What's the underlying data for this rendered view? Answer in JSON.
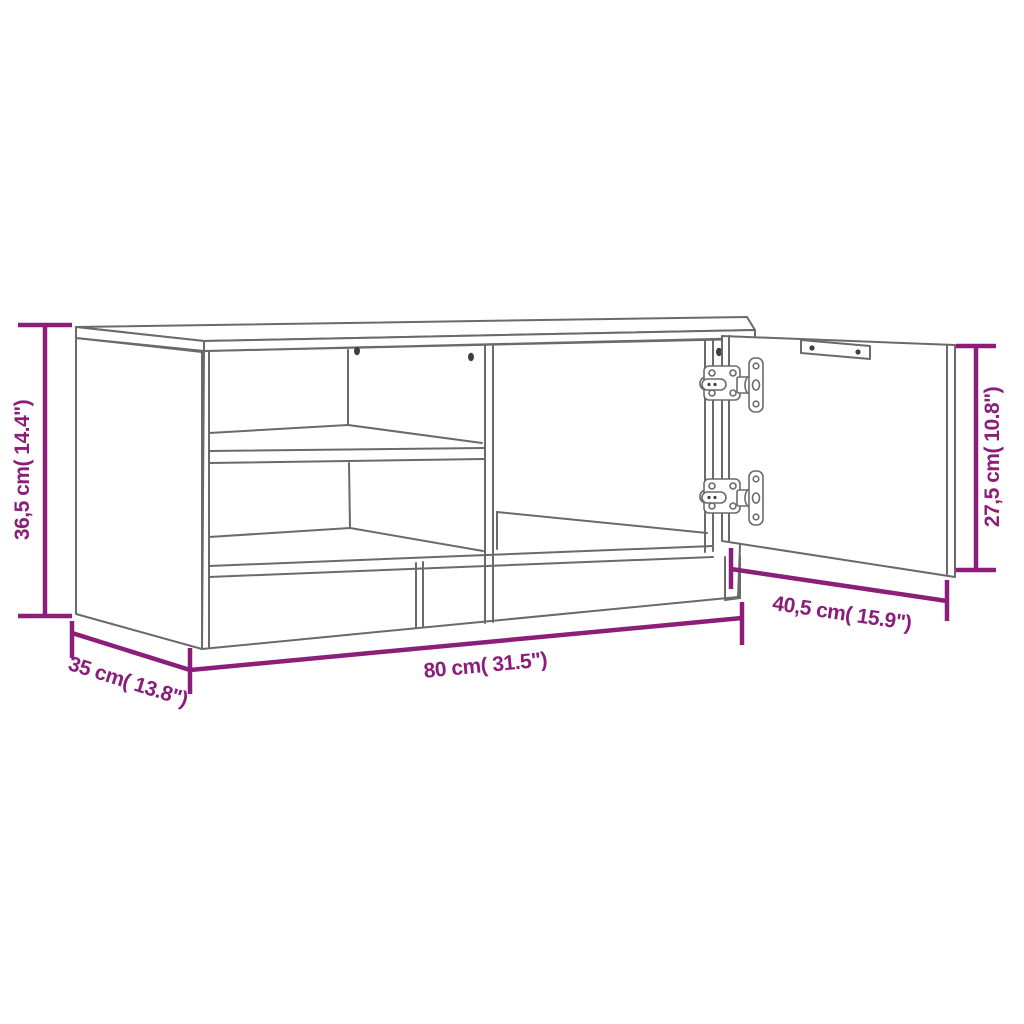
{
  "title": "TV cabinet dimension diagram",
  "colors": {
    "dimension_annotation": "#8B1E78",
    "outline": "#6A6A6A",
    "background": "#FFFFFF"
  },
  "dimensions": [
    {
      "name": "overall-height",
      "label": "36,5 cm( 14.4\")",
      "value_cm": "36,5",
      "value_in": "14.4"
    },
    {
      "name": "overall-width",
      "label": "80 cm( 31.5\")",
      "value_cm": "80",
      "value_in": "31.5"
    },
    {
      "name": "overall-depth",
      "label": "35 cm( 13.8\")",
      "value_cm": "35",
      "value_in": "13.8"
    },
    {
      "name": "door-width",
      "label": "40,5 cm( 15.9\")",
      "value_cm": "40,5",
      "value_in": "15.9"
    },
    {
      "name": "door-height",
      "label": "27,5 cm( 10.8\")",
      "value_cm": "27,5",
      "value_in": "10.8"
    }
  ]
}
